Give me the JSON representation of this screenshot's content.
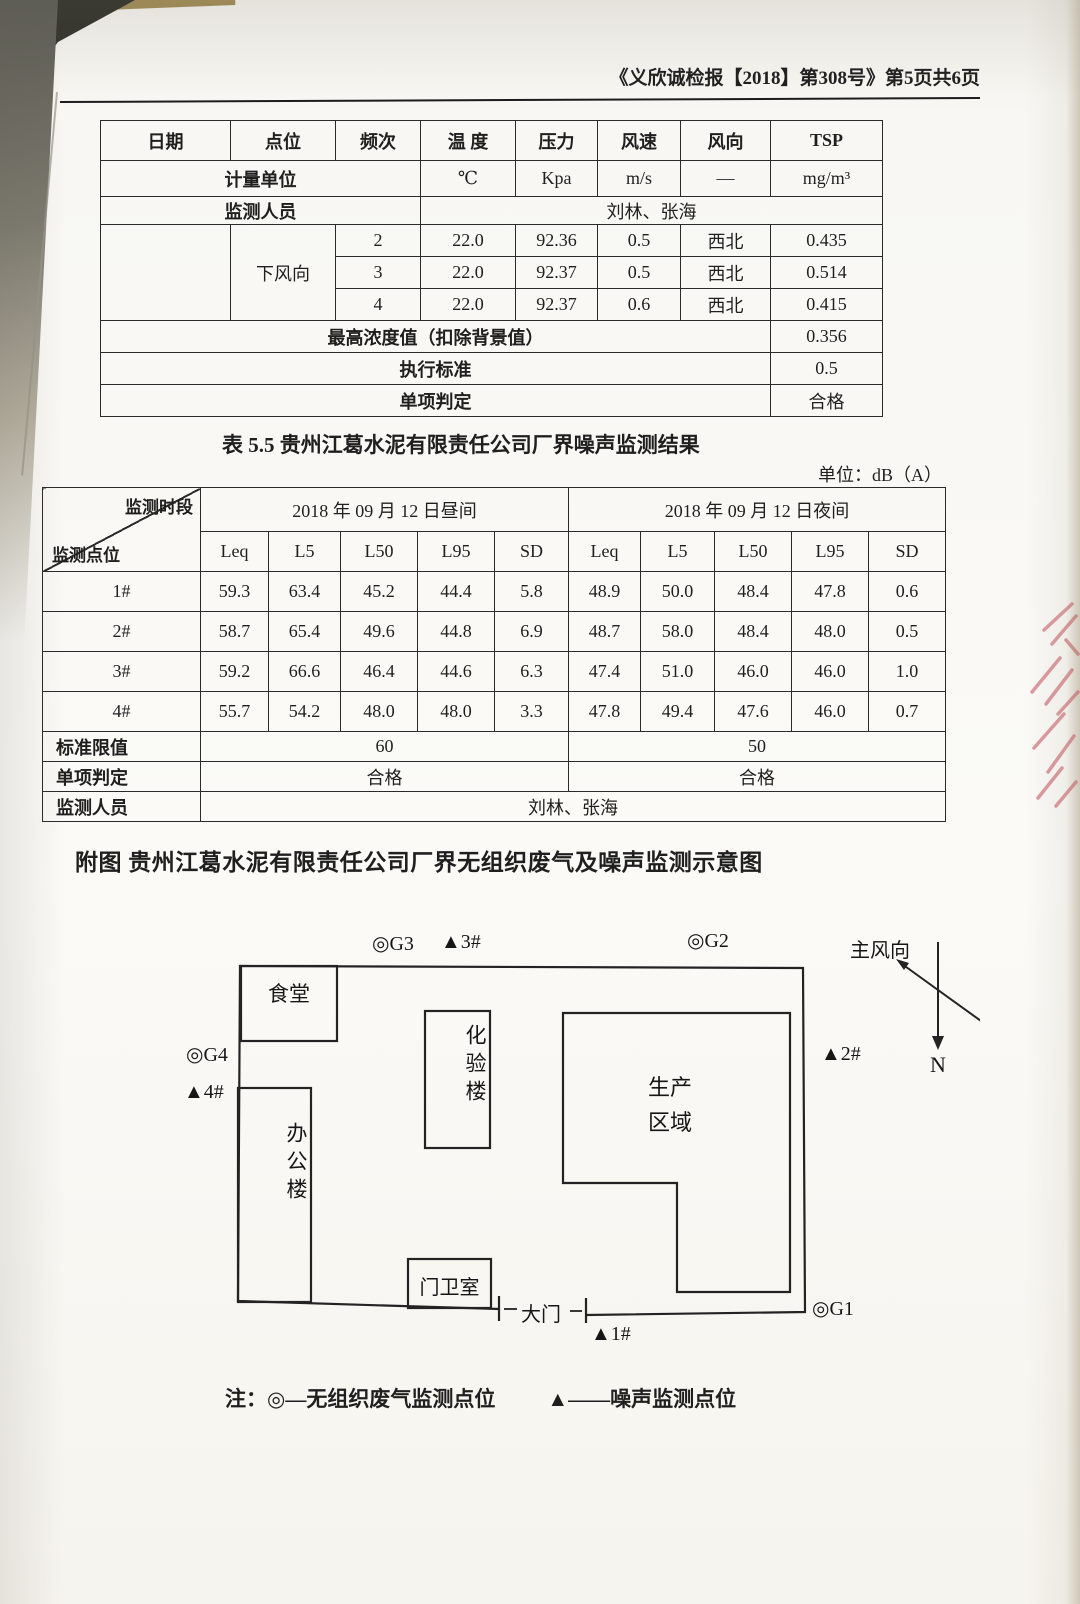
{
  "page": {
    "header": "《义欣诚检报【2018】第308号》第5页共6页"
  },
  "gas_table": {
    "headers": [
      "日期",
      "点位",
      "频次",
      "温 度",
      "压力",
      "风速",
      "风向",
      "TSP"
    ],
    "unit": {
      "label": "计量单位",
      "temp": "℃",
      "pressure": "Kpa",
      "wind_speed": "m/s",
      "wind_dir": "—",
      "tsp": "mg/m³"
    },
    "personnel": {
      "label": "监测人员",
      "value": "刘林、张海"
    },
    "position_label": "下风向",
    "rows": [
      {
        "freq": "2",
        "temp": "22.0",
        "pressure": "92.36",
        "wind_speed": "0.5",
        "wind_dir": "西北",
        "tsp": "0.435"
      },
      {
        "freq": "3",
        "temp": "22.0",
        "pressure": "92.37",
        "wind_speed": "0.5",
        "wind_dir": "西北",
        "tsp": "0.514"
      },
      {
        "freq": "4",
        "temp": "22.0",
        "pressure": "92.37",
        "wind_speed": "0.6",
        "wind_dir": "西北",
        "tsp": "0.415"
      }
    ],
    "max_row": {
      "label": "最高浓度值（扣除背景值）",
      "value": "0.356"
    },
    "standard_row": {
      "label": "执行标准",
      "value": "0.5"
    },
    "judge_row": {
      "label": "单项判定",
      "value": "合格"
    }
  },
  "noise_caption": "表 5.5  贵州江葛水泥有限责任公司厂界噪声监测结果",
  "unit_note": "单位：dB（A）",
  "noise_table": {
    "corner": {
      "top": "监测时段",
      "bottom": "监测点位"
    },
    "day_header": "2018 年 09 月 12 日昼间",
    "night_header": "2018 年 09 月 12 日夜间",
    "sub_headers": [
      "Leq",
      "L5",
      "L50",
      "L95",
      "SD",
      "Leq",
      "L5",
      "L50",
      "L95",
      "SD"
    ],
    "rows": [
      {
        "label": "1#",
        "values": [
          "59.3",
          "63.4",
          "45.2",
          "44.4",
          "5.8",
          "48.9",
          "50.0",
          "48.4",
          "47.8",
          "0.6"
        ]
      },
      {
        "label": "2#",
        "values": [
          "58.7",
          "65.4",
          "49.6",
          "44.8",
          "6.9",
          "48.7",
          "58.0",
          "48.4",
          "48.0",
          "0.5"
        ]
      },
      {
        "label": "3#",
        "values": [
          "59.2",
          "66.6",
          "46.4",
          "44.6",
          "6.3",
          "47.4",
          "51.0",
          "46.0",
          "46.0",
          "1.0"
        ]
      },
      {
        "label": "4#",
        "values": [
          "55.7",
          "54.2",
          "48.0",
          "48.0",
          "3.3",
          "47.8",
          "49.4",
          "47.6",
          "46.0",
          "0.7"
        ]
      }
    ],
    "limit": {
      "label": "标准限值",
      "day": "60",
      "night": "50"
    },
    "judge": {
      "label": "单项判定",
      "day": "合格",
      "night": "合格"
    },
    "personnel": {
      "label": "监测人员",
      "value": "刘林、张海"
    }
  },
  "figure_title": "附图 贵州江葛水泥有限责任公司厂界无组织废气及噪声监测示意图",
  "diagram": {
    "buildings": {
      "canteen": "食堂",
      "office": "办公楼",
      "lab": "化验楼",
      "production_line1": "生产",
      "production_line2": "区域",
      "guard": "门卫室"
    },
    "gate": "大门",
    "wind_label": "主风向",
    "north_label": "N",
    "markers": {
      "g1": "◎G1",
      "g2": "◎G2",
      "g3": "◎G3",
      "g4": "◎G4",
      "n1": "▲1#",
      "n2": "▲2#",
      "n3": "▲3#",
      "n4": "▲4#"
    }
  },
  "legend": {
    "prefix": "注：",
    "gas": "◎—无组织废气监测点位",
    "noise": "▲——噪声监测点位"
  }
}
